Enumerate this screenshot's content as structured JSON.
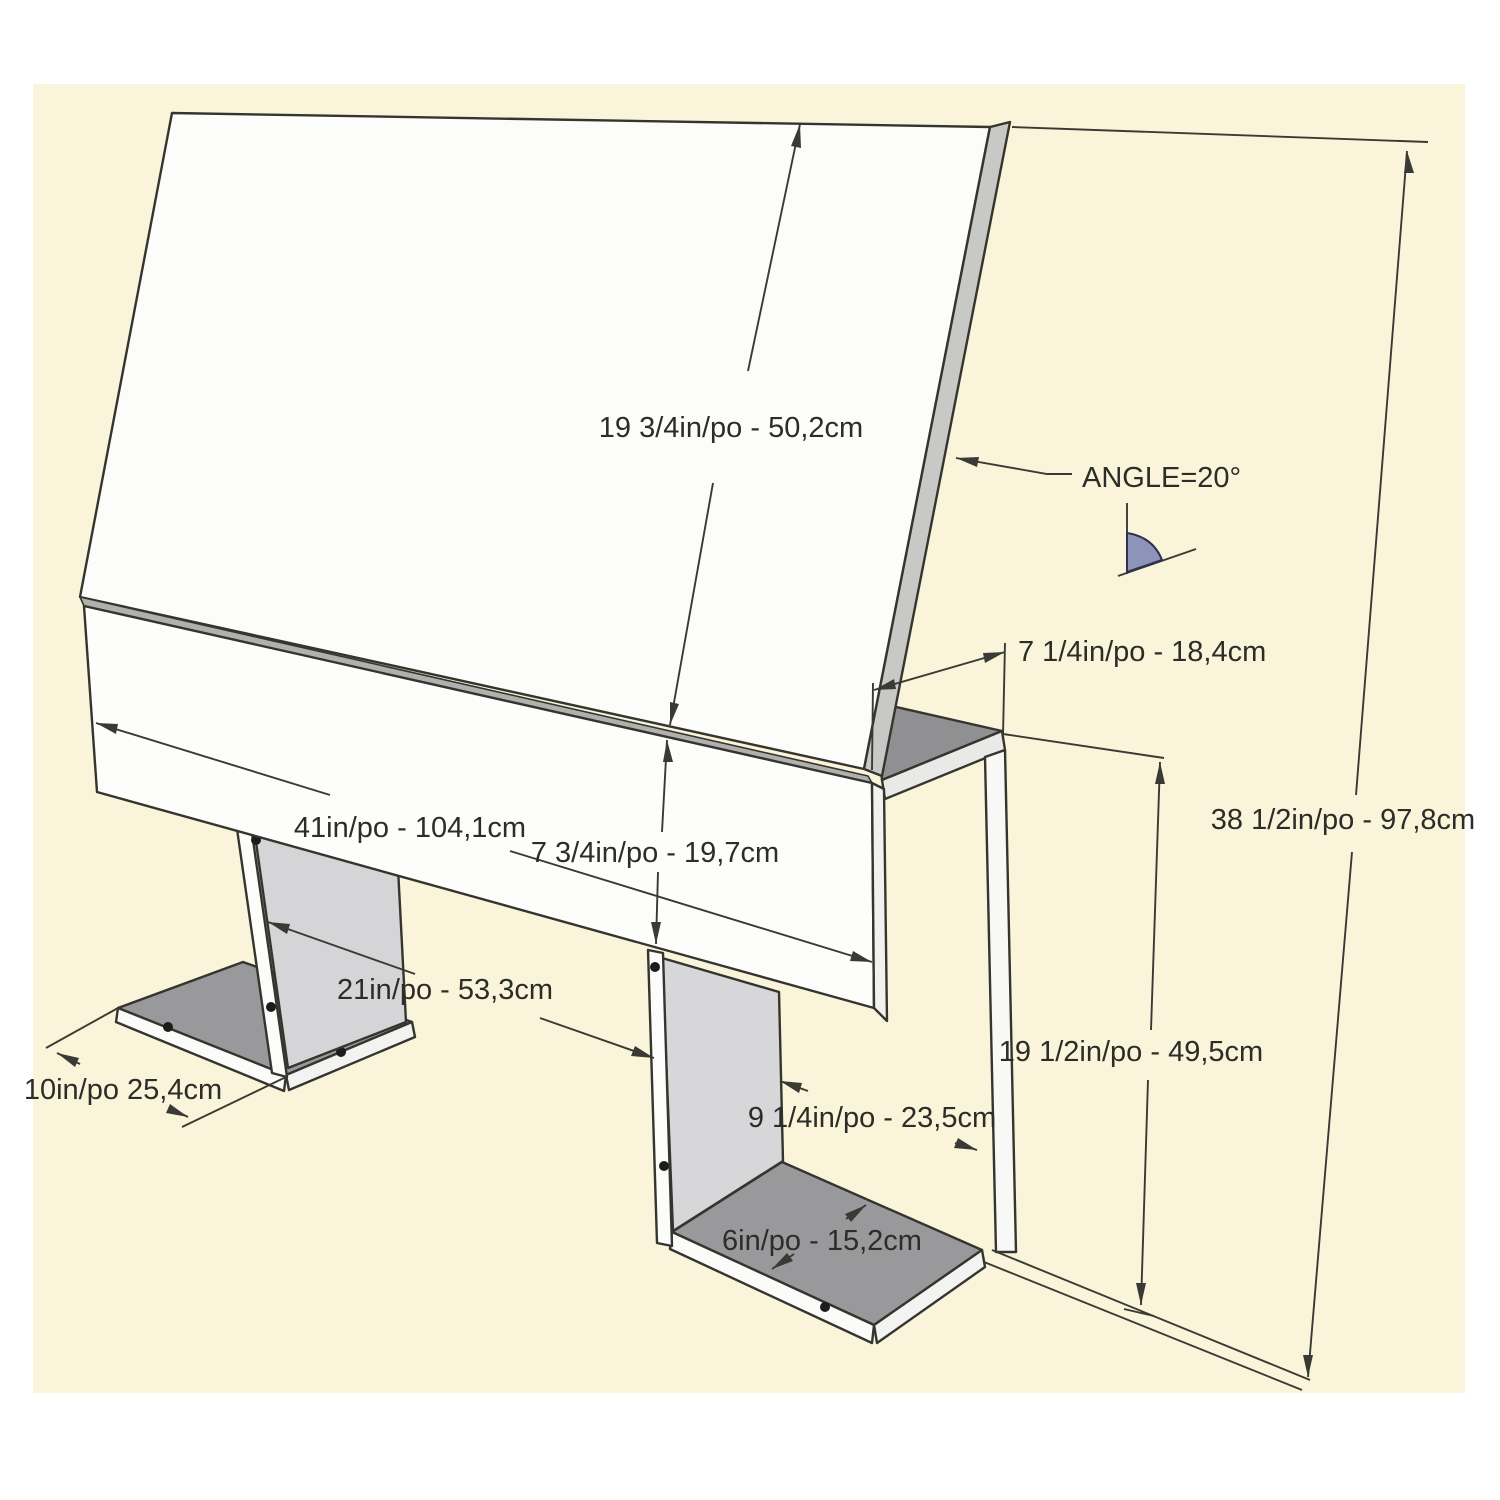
{
  "diagram": {
    "kind": "furniture-dimension-drawing",
    "subject": "headboard with angled top panel and two pedestal legs",
    "angle_value_deg": 20
  },
  "colors": {
    "paper": "#faf4da",
    "panel_white": "#fcfcfa",
    "panel_shaded": "#ededeb",
    "edge_grey": "#c8c8c6",
    "fold_grey": "#b0b0ae",
    "gusset_grey": "#d5d5d7",
    "base_top_grey": "#99999c",
    "triangle_grey": "#909093",
    "angle_glyph_fill": "#8e94b8",
    "line": "#3a3a34",
    "text": "#2c2c28"
  },
  "labels": {
    "panel_length": "19 3/4in/po - 50,2cm",
    "angle": "ANGLE=20°",
    "top_depth": "7 1/4in/po - 18,4cm",
    "overall_width": "41in/po - 104,1cm",
    "front_height": "7 3/4in/po - 19,7cm",
    "overall_height": "38 1/2in/po - 97,8cm",
    "leg_spacing": "21in/po - 53,3cm",
    "leg_height": "19 1/2in/po - 49,5cm",
    "leg_panel_width": "9 1/4in/po - 23,5cm",
    "base_width": "6in/po - 15,2cm",
    "base_depth": "10in/po 25,4cm"
  }
}
